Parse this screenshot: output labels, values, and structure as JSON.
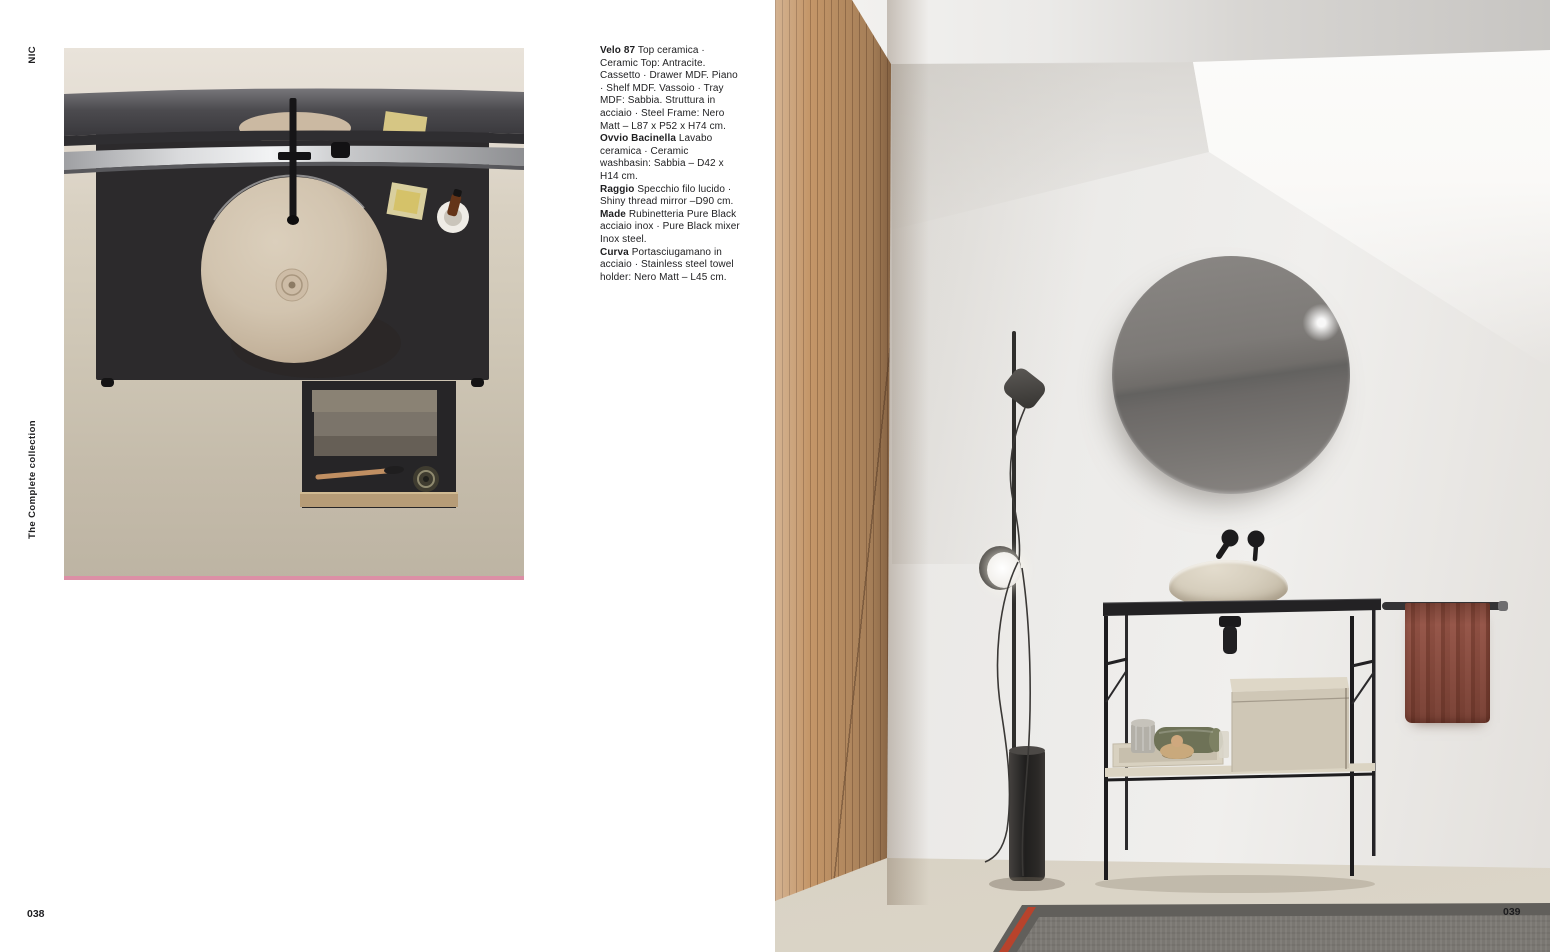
{
  "page": {
    "margin_labels": {
      "brand": "NIC",
      "collection": "The Complete collection"
    },
    "page_numbers": {
      "left": "038",
      "right": "039"
    }
  },
  "specs": {
    "segments": [
      {
        "name": "Velo 87",
        "text": " Top ceramica · Ceramic Top: Antracite. Cassetto · Drawer MDF. Piano · Shelf MDF. Vassoio · Tray MDF: Sabbia. Struttura in acciaio · Steel Frame: Nero Matt – L87 x P52 x H74 cm."
      },
      {
        "name": "Ovvio Bacinella",
        "text": " Lavabo ceramica · Ceramic washbasin: Sabbia – D42 x H14 cm."
      },
      {
        "name": "Raggio",
        "text": " Specchio filo lucido · Shiny thread mirror –D90 cm."
      },
      {
        "name": "Made",
        "text": " Rubinetteria Pure Black acciaio inox · Pure Black mixer Inox steel."
      },
      {
        "name": "Curva",
        "text": " Portasciugamano in acciaio · Stainless steel towel holder: Nero Matt – L45 cm."
      }
    ]
  },
  "colors": {
    "accent_pink_strip": "#dc8fa6",
    "wood_wall": "#c49668",
    "towel_terracotta": "#8b4e41",
    "rug_red_stripe": "#b8432c",
    "counter_black": "#2c2a2c",
    "basin_beige": "#d2c4af",
    "ink": "#1e1e20"
  }
}
